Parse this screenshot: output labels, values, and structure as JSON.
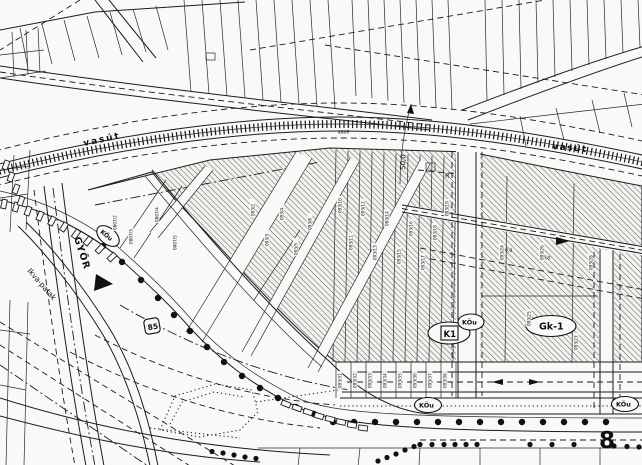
{
  "map": {
    "railway_label_left": "vasút",
    "railway_label_right": "vasút",
    "direction_label": "GYŐR",
    "stream_label": "Ikva-patak",
    "road_shield_main": "85",
    "road_number_bottom": "8",
    "railway_parcel_number": "4606",
    "setback_dimension": "50,0",
    "dim_a": "6,0",
    "dim_b": "16,0",
    "marker_r": "R",
    "zones": {
      "k1": "K1",
      "kou_center": "KÖu",
      "kou_bottom_mid": "KÖu",
      "kou_bottom_right": "KÖu",
      "kou_left": "KÖu",
      "gk1": "Gk-1"
    },
    "parcel_numbers": [
      "0807/2",
      "0807/3",
      "0807/4",
      "0807/5",
      "093/2",
      "093/3",
      "093/4",
      "093/5",
      "093/6",
      "093/10",
      "093/11",
      "093/12",
      "093/13",
      "093/14",
      "093/15",
      "093/16",
      "093/17",
      "093/18",
      "093/19",
      "093/24",
      "093/25",
      "093/26",
      "093/27",
      "093/28",
      "093/31",
      "093/32",
      "093/33",
      "093/34",
      "093/35",
      "093/36",
      "093/37",
      "093/38"
    ],
    "colors": {
      "ink": "#1c1c1c",
      "paper": "#f9f9f7",
      "hatch": "#5d5d5d"
    }
  }
}
